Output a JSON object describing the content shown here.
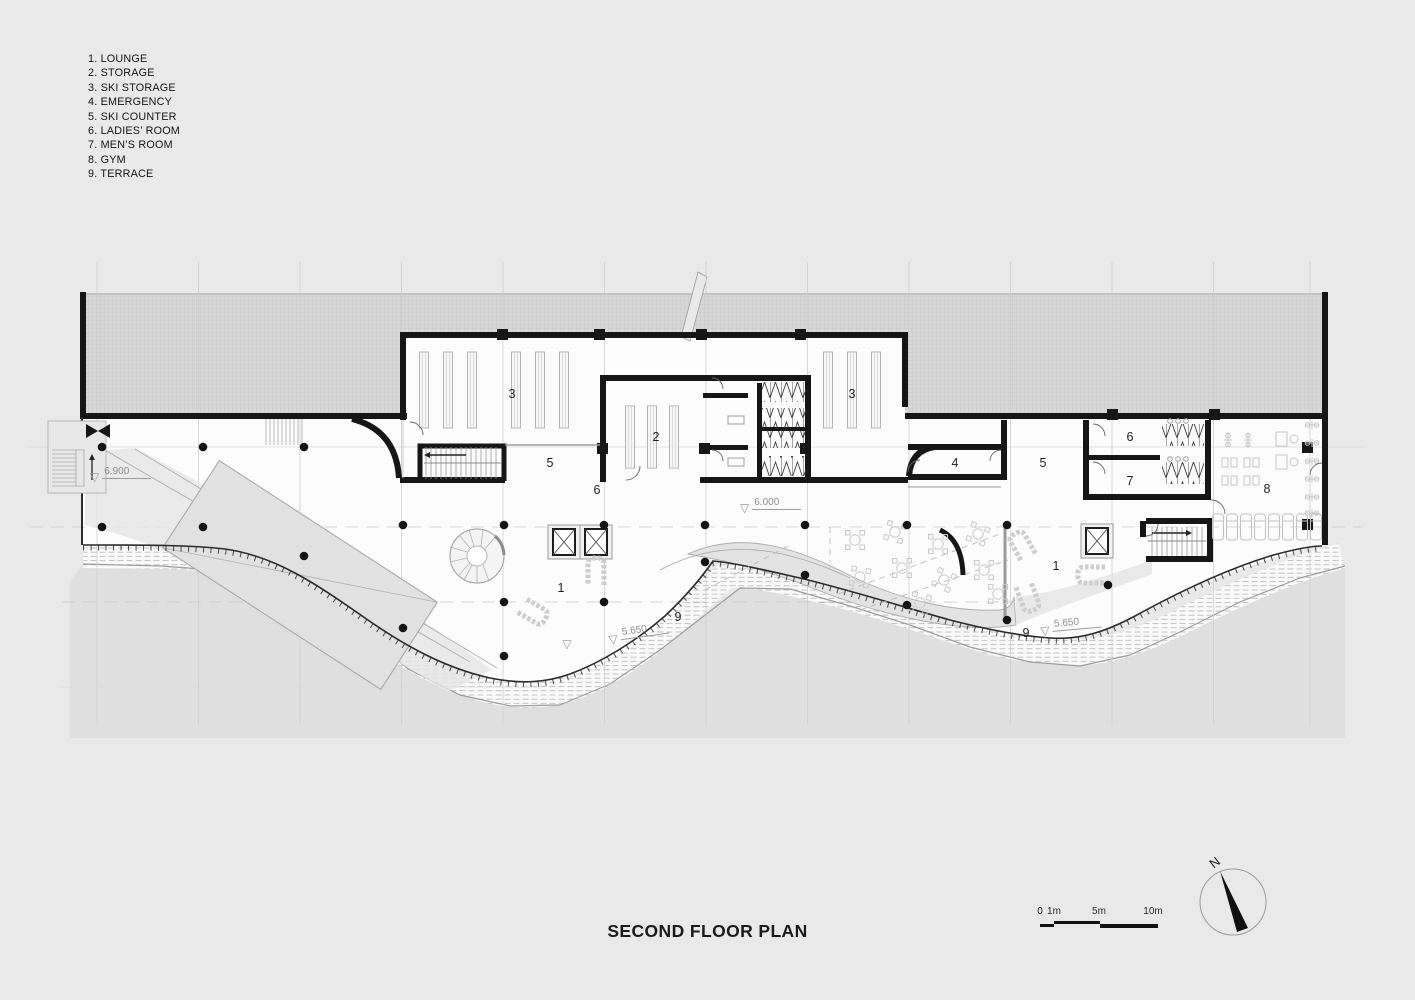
{
  "page": {
    "title": "SECOND FLOOR PLAN",
    "background": "#e9e9e9"
  },
  "colors": {
    "wall": "#161616",
    "roof_hatch_bg": "#d7d7d7",
    "roof_hatch_line": "#c7c7c7",
    "floor": "#fcfcfc",
    "ground": "#dfdfdf",
    "furniture": "#c9c9c9",
    "grid_line": "#cfcfcf",
    "level_text": "#8f8f8f"
  },
  "legend": {
    "items": [
      "1. LOUNGE",
      "2. STORAGE",
      "3. SKI STORAGE",
      "4. EMERGENCY",
      "5. SKI COUNTER",
      "6. LADIES’ ROOM",
      "7. MEN’S ROOM",
      "8. GYM",
      "9. TERRACE"
    ]
  },
  "plan": {
    "room_labels": [
      {
        "text": "3",
        "x": 512,
        "y": 394
      },
      {
        "text": "2",
        "x": 656,
        "y": 437
      },
      {
        "text": "3",
        "x": 852,
        "y": 394
      },
      {
        "text": "5",
        "x": 550,
        "y": 463
      },
      {
        "text": "6",
        "x": 597,
        "y": 490
      },
      {
        "text": "4",
        "x": 955,
        "y": 463
      },
      {
        "text": "5",
        "x": 1043,
        "y": 463
      },
      {
        "text": "6",
        "x": 1130,
        "y": 437
      },
      {
        "text": "7",
        "x": 1130,
        "y": 481
      },
      {
        "text": "8",
        "x": 1267,
        "y": 489
      },
      {
        "text": "1",
        "x": 561,
        "y": 588
      },
      {
        "text": "1",
        "x": 1056,
        "y": 566
      },
      {
        "text": "9",
        "x": 678,
        "y": 617
      },
      {
        "text": "9",
        "x": 1026,
        "y": 633
      }
    ],
    "level_markers": [
      {
        "text": "6.900",
        "x": 90,
        "y": 466,
        "rotation": 0
      },
      {
        "text": "6.000",
        "x": 740,
        "y": 497,
        "rotation": 0
      },
      {
        "text": "5.650",
        "x": 608,
        "y": 629,
        "rotation": -8
      },
      {
        "text": "5.650",
        "x": 1040,
        "y": 620,
        "rotation": -5
      }
    ],
    "slope_markers": [
      {
        "x": 567,
        "y": 644
      }
    ]
  },
  "scale_bar": {
    "labels": [
      {
        "text": "0",
        "x": 0
      },
      {
        "text": "1m",
        "x": 14
      },
      {
        "text": "5m",
        "x": 59
      },
      {
        "text": "10m",
        "x": 113
      }
    ]
  },
  "compass": {
    "label": "N"
  }
}
